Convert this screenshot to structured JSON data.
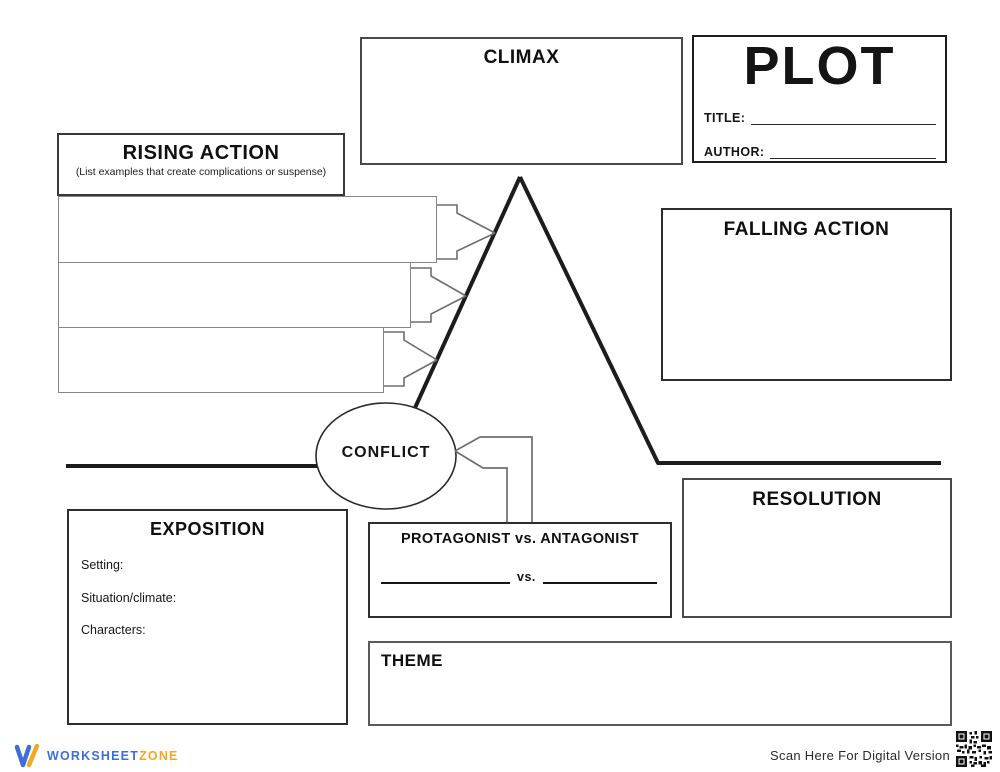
{
  "climax": {
    "title": "CLIMAX"
  },
  "plot_header": {
    "title": "PLOT",
    "title_label": "TITLE:",
    "author_label": "AUTHOR:"
  },
  "rising_action": {
    "title": "RISING ACTION",
    "subtitle": "(List examples that create complications or suspense)"
  },
  "falling_action": {
    "title": "FALLING ACTION"
  },
  "conflict": {
    "label": "CONFLICT"
  },
  "protagonist": {
    "title": "PROTAGONIST vs. ANTAGONIST",
    "vs_label": "vs."
  },
  "exposition": {
    "title": "EXPOSITION",
    "fields": [
      "Setting:",
      "Situation/climate:",
      "Characters:"
    ]
  },
  "resolution": {
    "title": "RESOLUTION"
  },
  "theme": {
    "title": "THEME"
  },
  "footer": {
    "brand_first": "WORKSHEET",
    "brand_second": "ZONE",
    "scan_label": "Scan Here For Digital Version"
  },
  "colors": {
    "line_black": "#1c1c1c",
    "box_gray": "#868686",
    "arrow_gray": "#6e6e6e",
    "brand_blue": "#3d6fd7",
    "brand_orange": "#f5a623"
  }
}
